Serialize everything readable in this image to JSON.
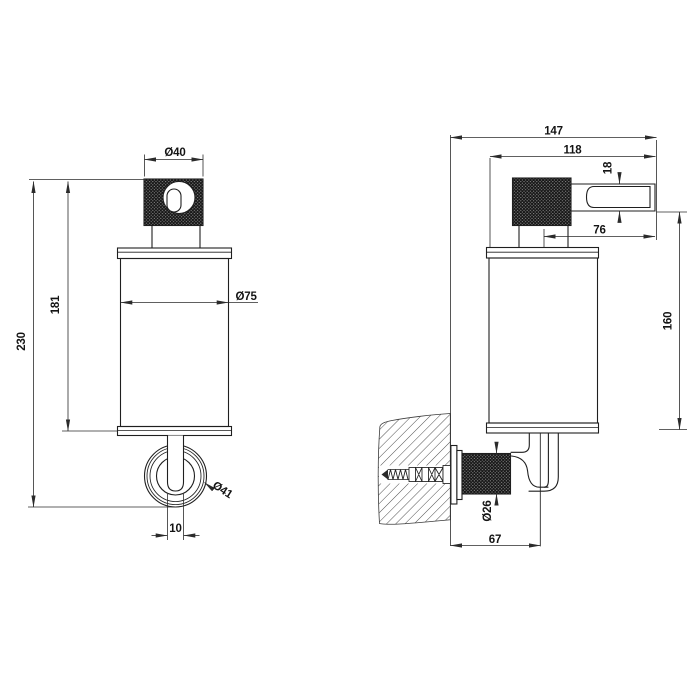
{
  "colors": {
    "background": "#ffffff",
    "line": "#1f1f1f",
    "dimension_line": "#2b2b2b",
    "text": "#141414",
    "knurl_dark": "#141414"
  },
  "dims": {
    "knob_diameter": "Ø40",
    "body_diameter": "Ø75",
    "body_height": "181",
    "total_height": "230",
    "rosette_diameter": "Ø41",
    "tube_width": "10",
    "total_depth": "147",
    "upper_depth": "118",
    "spout_diameter": "18",
    "spout_length": "76",
    "side_height": "160",
    "mount_diameter": "Ø26",
    "mount_depth": "67"
  }
}
